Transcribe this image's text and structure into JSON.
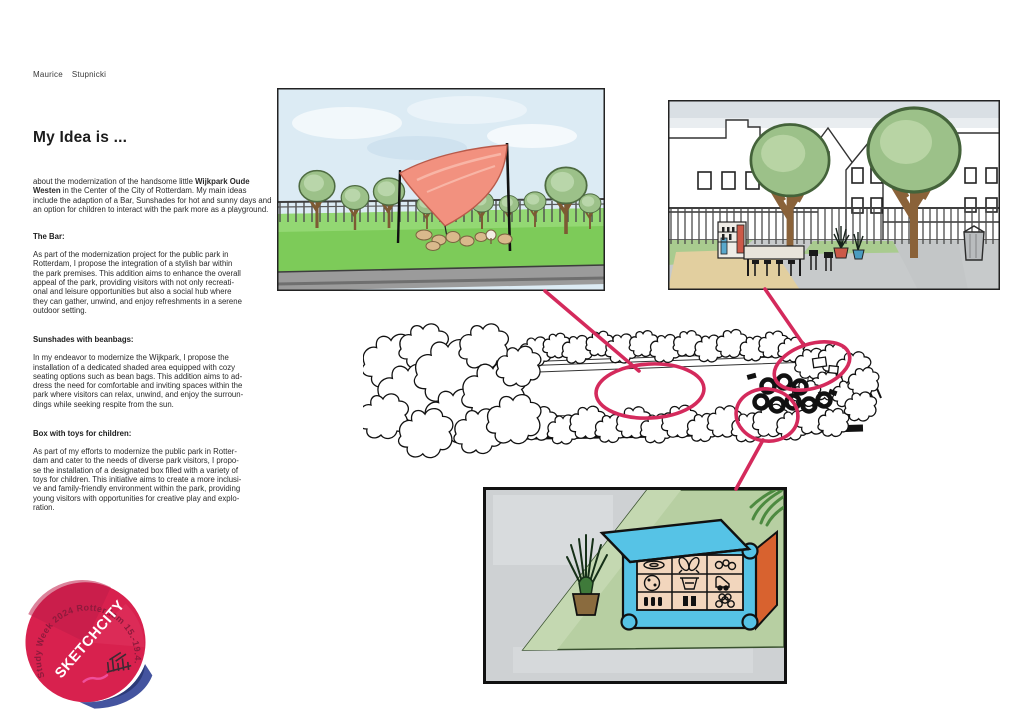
{
  "header": {
    "author_first": "Maurice",
    "author_last": "Stupnicki",
    "title": "My Idea is ..."
  },
  "article": {
    "intro_lead": "about the modernization of the handsome little ",
    "intro_bold": "Wijkpark Oude Westen",
    "intro_rest": " in the Center of the City of Rotterdam. My main ideas include the adaption of a Bar, Sunshades for hot and sunny days and an option for children to interact with the park more as a playground.",
    "sections": [
      {
        "heading": "The Bar:",
        "body": "As part of the modernization project for the public park in\nRotterdam, I propose the integration of a stylish bar within\nthe park premises. This addition aims to enhance the overall\nappeal of the park, providing visitors with not only recreati-\nonal and leisure opportunities but also a social hub where\nthey can gather, unwind, and enjoy refreshments in a serene\noutdoor setting."
      },
      {
        "heading": "Sunshades with beanbags:",
        "body": "In my endeavor to modernize the Wijkpark, I propose the\ninstallation of a dedicated shaded area equipped with cozy\nseating options such as bean bags. This addition aims to ad-\ndress the need for comfortable and inviting spaces within the\npark where visitors can relax, unwind, and enjoy the surroun-\ndings while seeking respite from the sun."
      },
      {
        "heading": "Box with toys for children:",
        "body": "As part of my efforts to modernize the public park in Rotter-\ndam and cater to the needs of diverse park visitors, I propo-\nse the installation of a designated box filled with a variety of\ntoys for children. This initiative aims to create a more inclusi-\nve and family-friendly environment within the park, providing\nyoung visitors with opportunities for creative play and explo-\nration."
      }
    ]
  },
  "figures": {
    "top_left": "sunshade-park-sketch",
    "top_right": "street-bar-sketch",
    "plan": "park-plan-sketch",
    "bottom": "toy-box-sketch"
  },
  "sticker": {
    "rim_text": "Study Week 2024 Rotterdam 15.-19.4.2024",
    "title": "SKETCHCITY"
  },
  "colors": {
    "annotation_pink": "#d42a5c",
    "sail_red": "#f2917f",
    "sticker_red": "#d8214e",
    "sticker_blue": "#44549f",
    "grass_green": "#7dcb59"
  }
}
